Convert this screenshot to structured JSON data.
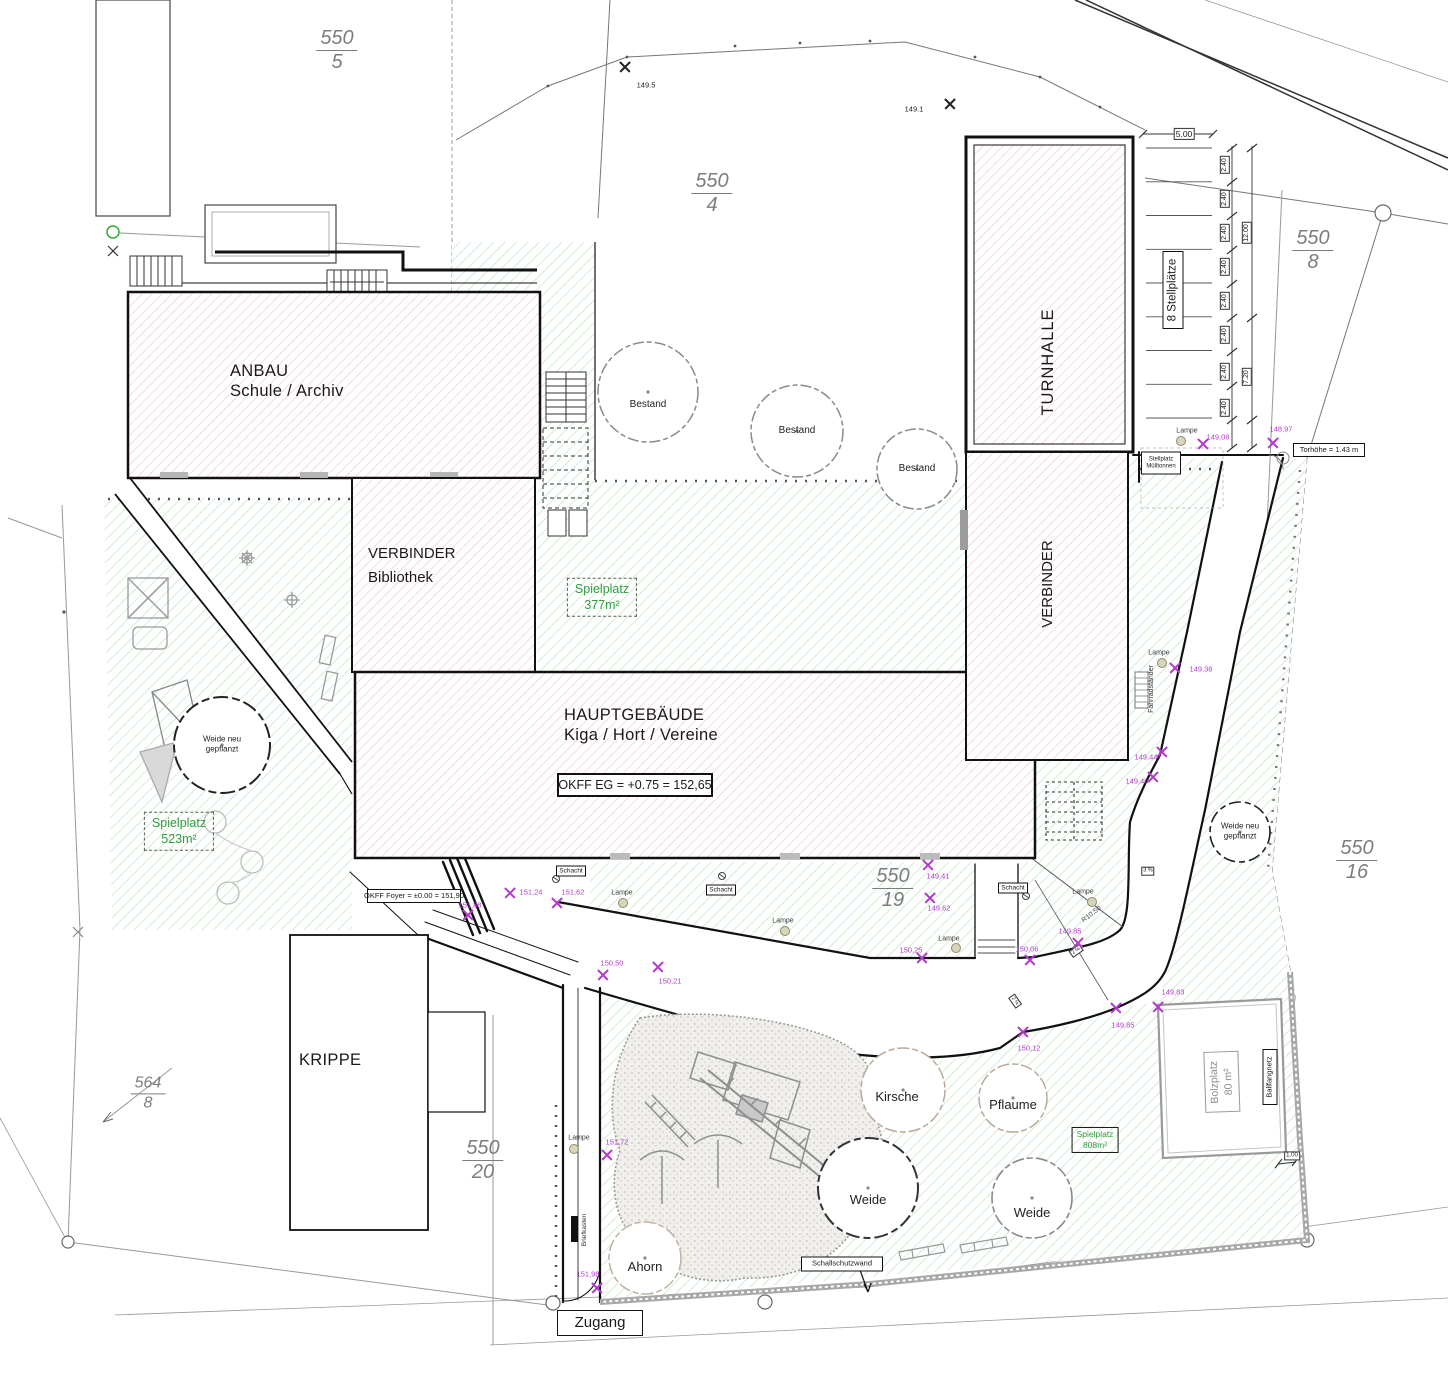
{
  "colors": {
    "magenta": "#b23ccc",
    "green_text": "#2f9e3f",
    "green_hatch": "#c2e5c2",
    "pink_hatch": "#f2c9c9"
  },
  "parcels": [
    {
      "num": "550",
      "den": "5"
    },
    {
      "num": "550",
      "den": "4"
    },
    {
      "num": "550",
      "den": "8"
    },
    {
      "num": "550",
      "den": "16"
    },
    {
      "num": "550",
      "den": "19"
    },
    {
      "num": "550",
      "den": "20"
    },
    {
      "num": "564",
      "den": "8"
    }
  ],
  "buildings": {
    "anbau": {
      "line1": "ANBAU",
      "line2": "Schule / Archiv"
    },
    "verbinder_bibliothek": {
      "line1": "VERBINDER",
      "line2": "Bibliothek"
    },
    "hauptgebaeude": {
      "line1": "HAUPTGEBÄUDE",
      "line2": "Kiga / Hort / Vereine"
    },
    "turnhalle": "TURNHALLE",
    "verbinder": "VERBINDER",
    "krippe": "KRIPPE"
  },
  "boxes": {
    "okff_eg": "OKFF EG = +0.75 = 152,65",
    "okff_foyer": "OKFF Foyer = ±0.00 = 151,90",
    "torhoehe": "Torhöhe = 1.43 m",
    "stellplatz_line1": "Stellplatz",
    "stellplatz_line2": "Mülltonnen",
    "zugang": "Zugang",
    "schallschutzwand": "Schallschutzwand",
    "schacht": "Schacht",
    "ballfangnetz": "Ballfangnetz",
    "bolzplatz_line1": "Bolzplatz",
    "bolzplatz_line2": "80 m²",
    "stellplaetze": "8 Stellplätze"
  },
  "green_labels": [
    {
      "line1": "Spielplatz",
      "line2": "377m²"
    },
    {
      "line1": "Spielplatz",
      "line2": "523m²"
    },
    {
      "line1": "Spielplatz",
      "line2": "808m²"
    }
  ],
  "dims": {
    "d500": "5.00",
    "d240": "2.40",
    "d1200": "12.00",
    "d720": "7.20",
    "d100": "1.00"
  },
  "small_labels": {
    "lampe": "Lampe",
    "fahrradstaender": "Fahrradständer",
    "briefkasten": "Briefkasten",
    "radius": "R10,50",
    "grad3": "3 %",
    "grad2": "2 %"
  },
  "trees": [
    {
      "label": "Bestand",
      "x": 648,
      "y": 405,
      "s": 10
    },
    {
      "label": "Bestand",
      "x": 797,
      "y": 431,
      "s": 10
    },
    {
      "label": "Bestand",
      "x": 917,
      "y": 469,
      "s": 10
    },
    {
      "label": "Weide neu gepflanzt",
      "x": 222,
      "y": 744,
      "s": 8,
      "w": 66
    },
    {
      "label": "Weide neu gepflanzt",
      "x": 1240,
      "y": 831,
      "s": 8,
      "w": 66
    },
    {
      "label": "Kirsche",
      "x": 897,
      "y": 1097,
      "s": 13
    },
    {
      "label": "Pflaume",
      "x": 1013,
      "y": 1105,
      "s": 13
    },
    {
      "label": "Weide",
      "x": 868,
      "y": 1200,
      "s": 13
    },
    {
      "label": "Weide",
      "x": 1032,
      "y": 1213,
      "s": 13
    },
    {
      "label": "Ahorn",
      "x": 645,
      "y": 1267,
      "s": 13
    }
  ],
  "points": [
    {
      "label": "149.5",
      "x": 625,
      "y": 67,
      "lx": 646,
      "ly": 85,
      "black": true
    },
    {
      "label": "149.1",
      "x": 950,
      "y": 104,
      "lx": 914,
      "ly": 109,
      "black": true
    },
    {
      "label": "148,97",
      "x": 1273,
      "y": 443,
      "lx": 1281,
      "ly": 429
    },
    {
      "label": "149,08",
      "x": 1203,
      "y": 444,
      "lx": 1218,
      "ly": 437
    },
    {
      "label": "149,38",
      "x": 1175,
      "y": 668,
      "lx": 1201,
      "ly": 669
    },
    {
      "label": "149,44",
      "x": 1162,
      "y": 752,
      "lx": 1146,
      "ly": 757
    },
    {
      "label": "149,46",
      "x": 1153,
      "y": 777,
      "lx": 1137,
      "ly": 781
    },
    {
      "label": "151,88",
      "x": 468,
      "y": 915,
      "lx": 470,
      "ly": 905
    },
    {
      "label": "151,24",
      "x": 510,
      "y": 893,
      "lx": 531,
      "ly": 892
    },
    {
      "label": "151,62",
      "x": 557,
      "y": 903,
      "lx": 573,
      "ly": 892
    },
    {
      "label": "150,50",
      "x": 603,
      "y": 975,
      "lx": 612,
      "ly": 963
    },
    {
      "label": "150,21",
      "x": 658,
      "y": 967,
      "lx": 670,
      "ly": 981
    },
    {
      "label": "150,25",
      "x": 922,
      "y": 958,
      "lx": 911,
      "ly": 950
    },
    {
      "label": "149,41",
      "x": 928,
      "y": 865,
      "lx": 938,
      "ly": 876
    },
    {
      "label": "149,62",
      "x": 930,
      "y": 898,
      "lx": 939,
      "ly": 908
    },
    {
      "label": "150,06",
      "x": 1030,
      "y": 960,
      "lx": 1027,
      "ly": 949
    },
    {
      "label": "150,12",
      "x": 1023,
      "y": 1032,
      "lx": 1029,
      "ly": 1048
    },
    {
      "label": "149,85",
      "x": 1078,
      "y": 943,
      "lx": 1070,
      "ly": 931
    },
    {
      "label": "149,85",
      "x": 1116,
      "y": 1008,
      "lx": 1123,
      "ly": 1025
    },
    {
      "label": "149,83",
      "x": 1158,
      "y": 1007,
      "lx": 1173,
      "ly": 992
    },
    {
      "label": "151,72",
      "x": 607,
      "y": 1155,
      "lx": 617,
      "ly": 1142
    },
    {
      "label": "151,98",
      "x": 597,
      "y": 1288,
      "lx": 588,
      "ly": 1274
    }
  ],
  "lamps": [
    {
      "x": 1181,
      "y": 441,
      "lx": 1187,
      "ly": 431
    },
    {
      "x": 1162,
      "y": 663,
      "lx": 1159,
      "ly": 653
    },
    {
      "x": 623,
      "y": 903,
      "lx": 622,
      "ly": 893
    },
    {
      "x": 785,
      "y": 931,
      "lx": 783,
      "ly": 921
    },
    {
      "x": 956,
      "y": 948,
      "lx": 949,
      "ly": 939
    },
    {
      "x": 1092,
      "y": 902,
      "lx": 1083,
      "ly": 892
    },
    {
      "x": 574,
      "y": 1149,
      "lx": 579,
      "ly": 1138
    }
  ]
}
